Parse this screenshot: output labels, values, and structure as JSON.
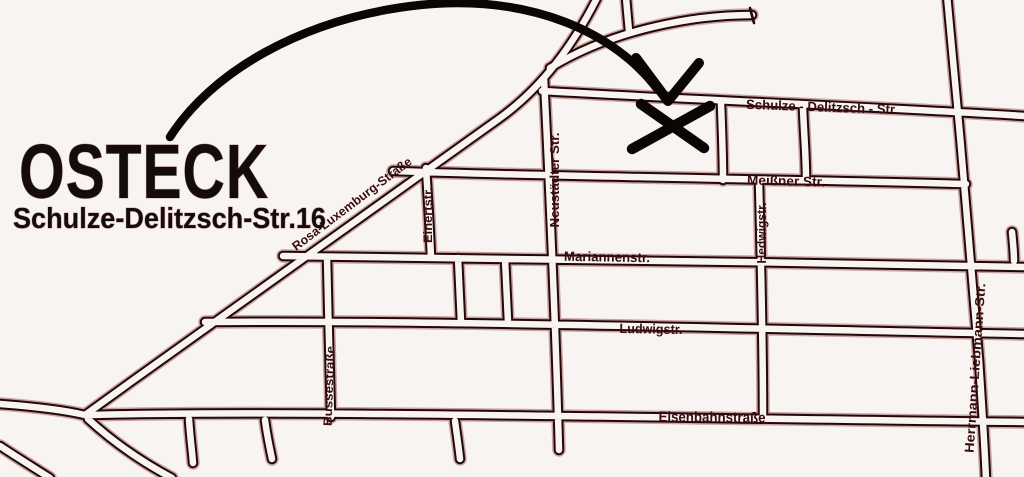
{
  "branding": {
    "title": "OSTECK",
    "subtitle": "Schulze-Delitzsch-Str.16"
  },
  "streets": {
    "horizontal": [
      {
        "label": "Schulze - Delitzsch - Str."
      },
      {
        "label": "Meißner Str."
      },
      {
        "label": "Mariannenstr."
      },
      {
        "label": "Ludwigstr."
      },
      {
        "label": "Eisenbahnstraße"
      }
    ],
    "vertical": [
      {
        "label": "Neustädter Str."
      },
      {
        "label": "Einertstr."
      },
      {
        "label": "Hedwigstr."
      },
      {
        "label": "Bussestraße"
      },
      {
        "label": "Herrmann-Liebmann-Str."
      }
    ],
    "diagonal": [
      {
        "label": "Rosa-Luxemburg-Straße"
      }
    ]
  },
  "map": {
    "background": "#f8f4f2",
    "road_line_color": "#230808",
    "road_halo_color": "#9c5050",
    "label_color": "#3a0d0e",
    "arrow_ink_color": "#0c0506"
  }
}
